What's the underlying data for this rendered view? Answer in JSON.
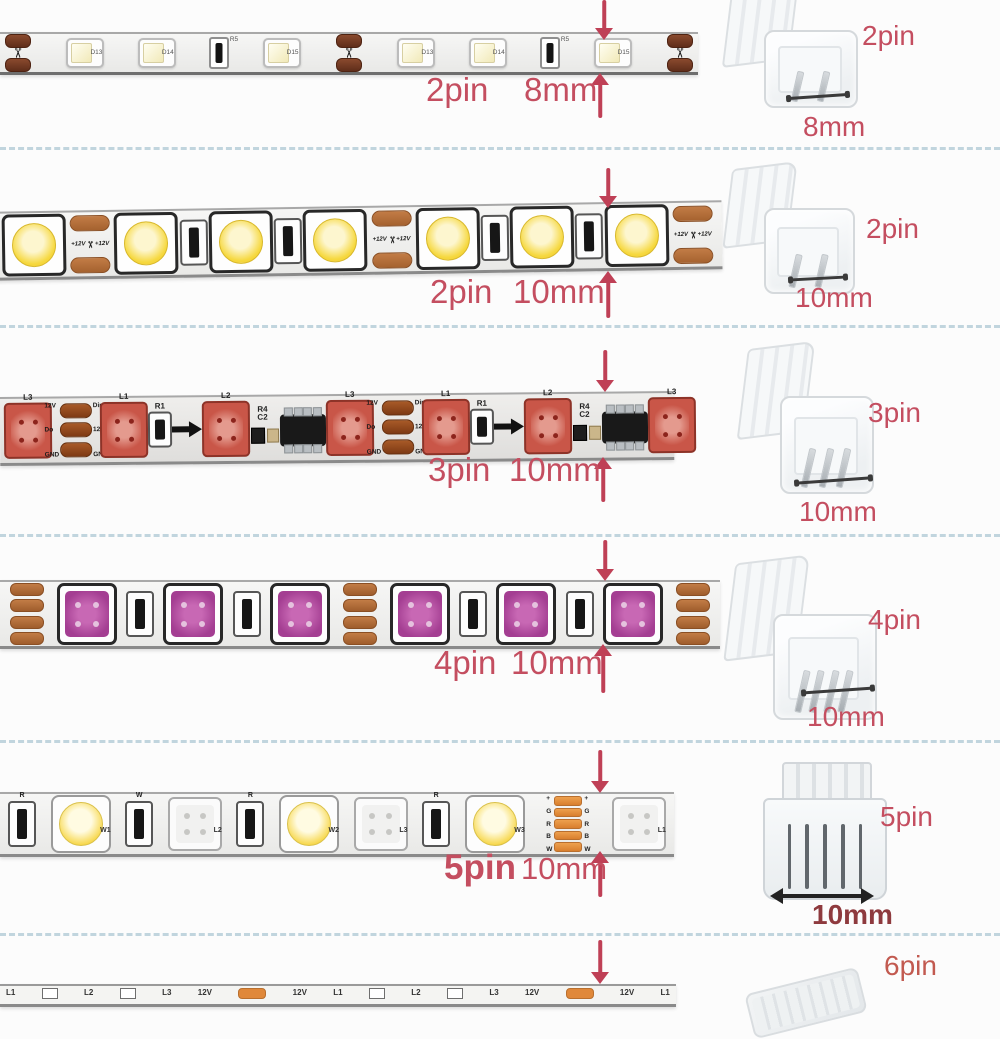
{
  "colors": {
    "caption_red": "#c44e60",
    "arrow_red": "#bf4056",
    "dark_size_red": "#8e3a3e",
    "sixpin_red": "#c25a50",
    "separator_blue": "#b3ccd7",
    "copper_pad": "#a5622f",
    "orange_pad": "#e0883a"
  },
  "icons": {
    "scissors": "✂"
  },
  "rows": [
    {
      "strip_kind": "8mm single color 3528 strip",
      "caption": {
        "pin": "2pin",
        "size": "8mm"
      },
      "connector": {
        "pins": 2,
        "pin_label": "2pin",
        "size_label": "8mm",
        "view": "angled"
      },
      "strip": {
        "segments": [
          {
            "t": "cut"
          },
          {
            "t": "led3528",
            "label": "D13"
          },
          {
            "t": "led3528",
            "label": "D14"
          },
          {
            "t": "res",
            "label": "R5"
          },
          {
            "t": "led3528",
            "label": "D15"
          },
          {
            "t": "cut"
          },
          {
            "t": "led3528",
            "label": "D13"
          },
          {
            "t": "led3528",
            "label": "D14"
          },
          {
            "t": "res",
            "label": "R5"
          },
          {
            "t": "led3528",
            "label": "D15"
          },
          {
            "t": "cut"
          }
        ]
      }
    },
    {
      "strip_kind": "10mm single color 5050 strip",
      "caption": {
        "pin": "2pin",
        "size": "10mm"
      },
      "connector": {
        "pins": 2,
        "pin_label": "2pin",
        "size_label": "10mm",
        "view": "angled"
      },
      "strip": {
        "segments": [
          {
            "t": "led5050",
            "color": "warm"
          },
          {
            "t": "pads2",
            "label": "+12V"
          },
          {
            "t": "led5050",
            "color": "warm"
          },
          {
            "t": "res2"
          },
          {
            "t": "led5050",
            "color": "warm"
          },
          {
            "t": "res2"
          },
          {
            "t": "led5050",
            "color": "warm"
          },
          {
            "t": "pads2",
            "label": "+12V"
          },
          {
            "t": "led5050",
            "color": "warm"
          },
          {
            "t": "res2"
          },
          {
            "t": "led5050",
            "color": "warm"
          },
          {
            "t": "res2"
          },
          {
            "t": "led5050",
            "color": "warm"
          },
          {
            "t": "pads2",
            "label": "+12V"
          }
        ]
      }
    },
    {
      "strip_kind": "10mm addressable pixel strip",
      "caption": {
        "pin": "3pin",
        "size": "10mm"
      },
      "connector": {
        "pins": 3,
        "pin_label": "3pin",
        "size_label": "10mm",
        "view": "angled"
      },
      "strip": {
        "segments": [
          {
            "t": "led5050",
            "color": "red",
            "top": "L3"
          },
          {
            "t": "pads3",
            "left": [
              "12V",
              "Do",
              "GND"
            ],
            "right": [
              "Din",
              "12V",
              "GND"
            ]
          },
          {
            "t": "led5050",
            "color": "red",
            "top": "L1"
          },
          {
            "t": "res2",
            "label": "R1",
            "small": true
          },
          {
            "t": "arrow"
          },
          {
            "t": "led5050",
            "color": "red",
            "top": "L2"
          },
          {
            "t": "parts",
            "label": "R4 C2"
          },
          {
            "t": "ic"
          },
          {
            "t": "led5050",
            "color": "red",
            "top": "L3"
          },
          {
            "t": "pads3",
            "left": [
              "12V",
              "Do",
              "GND"
            ],
            "right": [
              "Din",
              "12V",
              "GND"
            ]
          },
          {
            "t": "led5050",
            "color": "red",
            "top": "L1"
          },
          {
            "t": "res2",
            "label": "R1",
            "small": true
          },
          {
            "t": "arrow"
          },
          {
            "t": "led5050",
            "color": "red",
            "top": "L2"
          },
          {
            "t": "parts",
            "label": "R4 C2"
          },
          {
            "t": "ic"
          },
          {
            "t": "led5050",
            "color": "red",
            "top": "L3"
          }
        ]
      }
    },
    {
      "strip_kind": "10mm RGB 5050 strip",
      "caption": {
        "pin": "4pin",
        "size": "10mm"
      },
      "connector": {
        "pins": 4,
        "pin_label": "4pin",
        "size_label": "10mm",
        "view": "angled"
      },
      "strip": {
        "segments": [
          {
            "t": "pads4"
          },
          {
            "t": "led5050",
            "color": "magenta"
          },
          {
            "t": "res2"
          },
          {
            "t": "led5050",
            "color": "magenta"
          },
          {
            "t": "res2"
          },
          {
            "t": "led5050",
            "color": "magenta"
          },
          {
            "t": "pads4"
          },
          {
            "t": "led5050",
            "color": "magenta"
          },
          {
            "t": "res2"
          },
          {
            "t": "led5050",
            "color": "magenta"
          },
          {
            "t": "res2"
          },
          {
            "t": "led5050",
            "color": "magenta"
          },
          {
            "t": "pads4"
          }
        ]
      }
    },
    {
      "strip_kind": "10mm RGBW strip",
      "caption": {
        "pin": "5pin",
        "size": "10mm"
      },
      "connector": {
        "pins": 5,
        "pin_label": "5pin",
        "size_label": "10mm",
        "view": "front"
      },
      "strip": {
        "segments": [
          {
            "t": "res2",
            "label": "R",
            "r5": true
          },
          {
            "t": "ledround",
            "label": "W1"
          },
          {
            "t": "res2",
            "label": "W",
            "r5": true
          },
          {
            "t": "ledrgbw",
            "label": "L2"
          },
          {
            "t": "res2",
            "label": "R",
            "r5": true
          },
          {
            "t": "ledround",
            "label": "W2"
          },
          {
            "t": "ledrgbw",
            "label": "L3"
          },
          {
            "t": "res2",
            "label": "R",
            "r5": true
          },
          {
            "t": "ledround",
            "label": "W3"
          },
          {
            "t": "pads5",
            "labels": [
              "+",
              "G",
              "R",
              "B",
              "W"
            ]
          },
          {
            "t": "ledrgbw",
            "label": "L1"
          }
        ]
      }
    },
    {
      "strip_kind": "addressable strip (partial)",
      "caption": {
        "pin": "",
        "size": ""
      },
      "connector": {
        "pins": 6,
        "pin_label": "6pin",
        "size_label": "",
        "view": "mini"
      },
      "strip": {
        "segments": [
          {
            "t": "txt",
            "label": "L1"
          },
          {
            "t": "sq"
          },
          {
            "t": "txt",
            "label": "L2"
          },
          {
            "t": "sq"
          },
          {
            "t": "txt",
            "label": "L3"
          },
          {
            "t": "txt",
            "label": "12V"
          },
          {
            "t": "padh"
          },
          {
            "t": "txt",
            "label": "12V"
          },
          {
            "t": "txt",
            "label": "L1"
          },
          {
            "t": "sq"
          },
          {
            "t": "txt",
            "label": "L2"
          },
          {
            "t": "sq"
          },
          {
            "t": "txt",
            "label": "L3"
          },
          {
            "t": "txt",
            "label": "12V"
          },
          {
            "t": "padh"
          },
          {
            "t": "txt",
            "label": "12V"
          },
          {
            "t": "txt",
            "label": "L1"
          }
        ]
      }
    }
  ]
}
